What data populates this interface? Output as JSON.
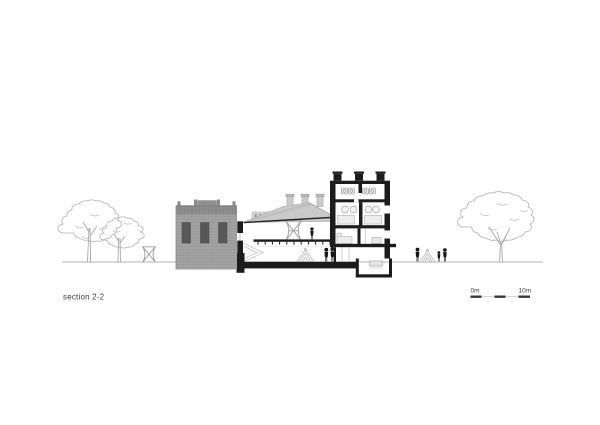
{
  "drawing": {
    "title": "section 2-2",
    "type": "architectural section drawing",
    "scale_bar": {
      "start_label": "0m",
      "end_label": "10m",
      "segments": 5
    },
    "palette": {
      "background": "#ffffff",
      "cut_poche_black": "#1c1c1c",
      "elevation_gray": "#a2a2a2",
      "window_gray": "#585858",
      "roof_gray": "#cacaca",
      "tree_outline_gray": "#b0b0b0",
      "ground_line_gray": "#9a9a9a",
      "text_gray": "#3a3a3a"
    },
    "scene": {
      "people_count": 6,
      "tree_count": 3,
      "lattice_sculpture_count": 2,
      "tent_count": 2,
      "chimney_count": 3,
      "left_elevation_window_count": 3,
      "tower_floor_count": 4
    }
  }
}
